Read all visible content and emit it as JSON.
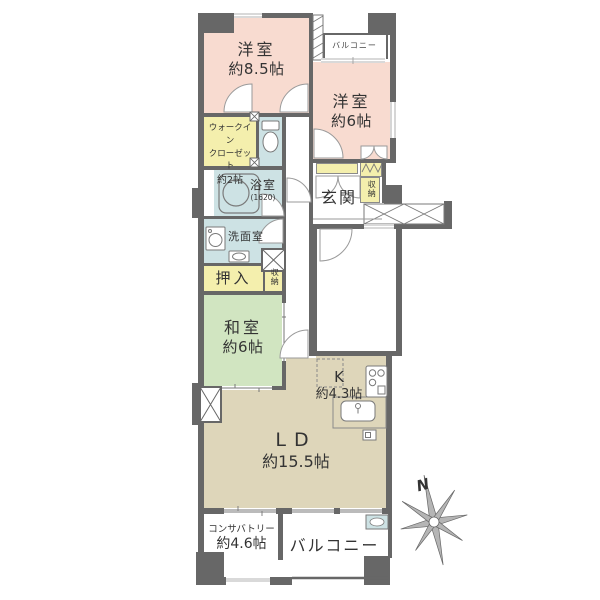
{
  "rooms": {
    "bedroom1": {
      "name": "洋室",
      "size": "約8.5帖"
    },
    "bedroom2": {
      "name": "洋室",
      "size": "約6帖"
    },
    "wic": {
      "line1": "ウォークイン",
      "line2": "クローゼット",
      "line3": "約2帖"
    },
    "bath": {
      "name": "浴室",
      "size": "(1620)"
    },
    "washroom": {
      "name": "洗面室"
    },
    "entrance": {
      "name": "玄関"
    },
    "storage_entrance": {
      "name": "収納"
    },
    "storage_hall": {
      "name": "収納"
    },
    "oshiire": {
      "name": "押入"
    },
    "washitsu": {
      "name": "和室",
      "size": "約6帖"
    },
    "kitchen": {
      "name": "K",
      "size": "約4.3帖"
    },
    "living_dining": {
      "name": "LD",
      "size": "約15.5帖"
    },
    "conservatory": {
      "name": "コンサバトリー",
      "size": "約4.6帖"
    },
    "balcony_top": {
      "name": "バルコニー"
    },
    "balcony_bottom": {
      "name": "バルコニー"
    }
  },
  "compass": {
    "north_label": "N"
  },
  "colors": {
    "wall": "#676767",
    "western_room": "#f8dbd0",
    "storage": "#f4efad",
    "wet_area": "#cde2e4",
    "tatami_room": "#d1e5c1",
    "living": "#ded6ba",
    "text": "#333333"
  }
}
